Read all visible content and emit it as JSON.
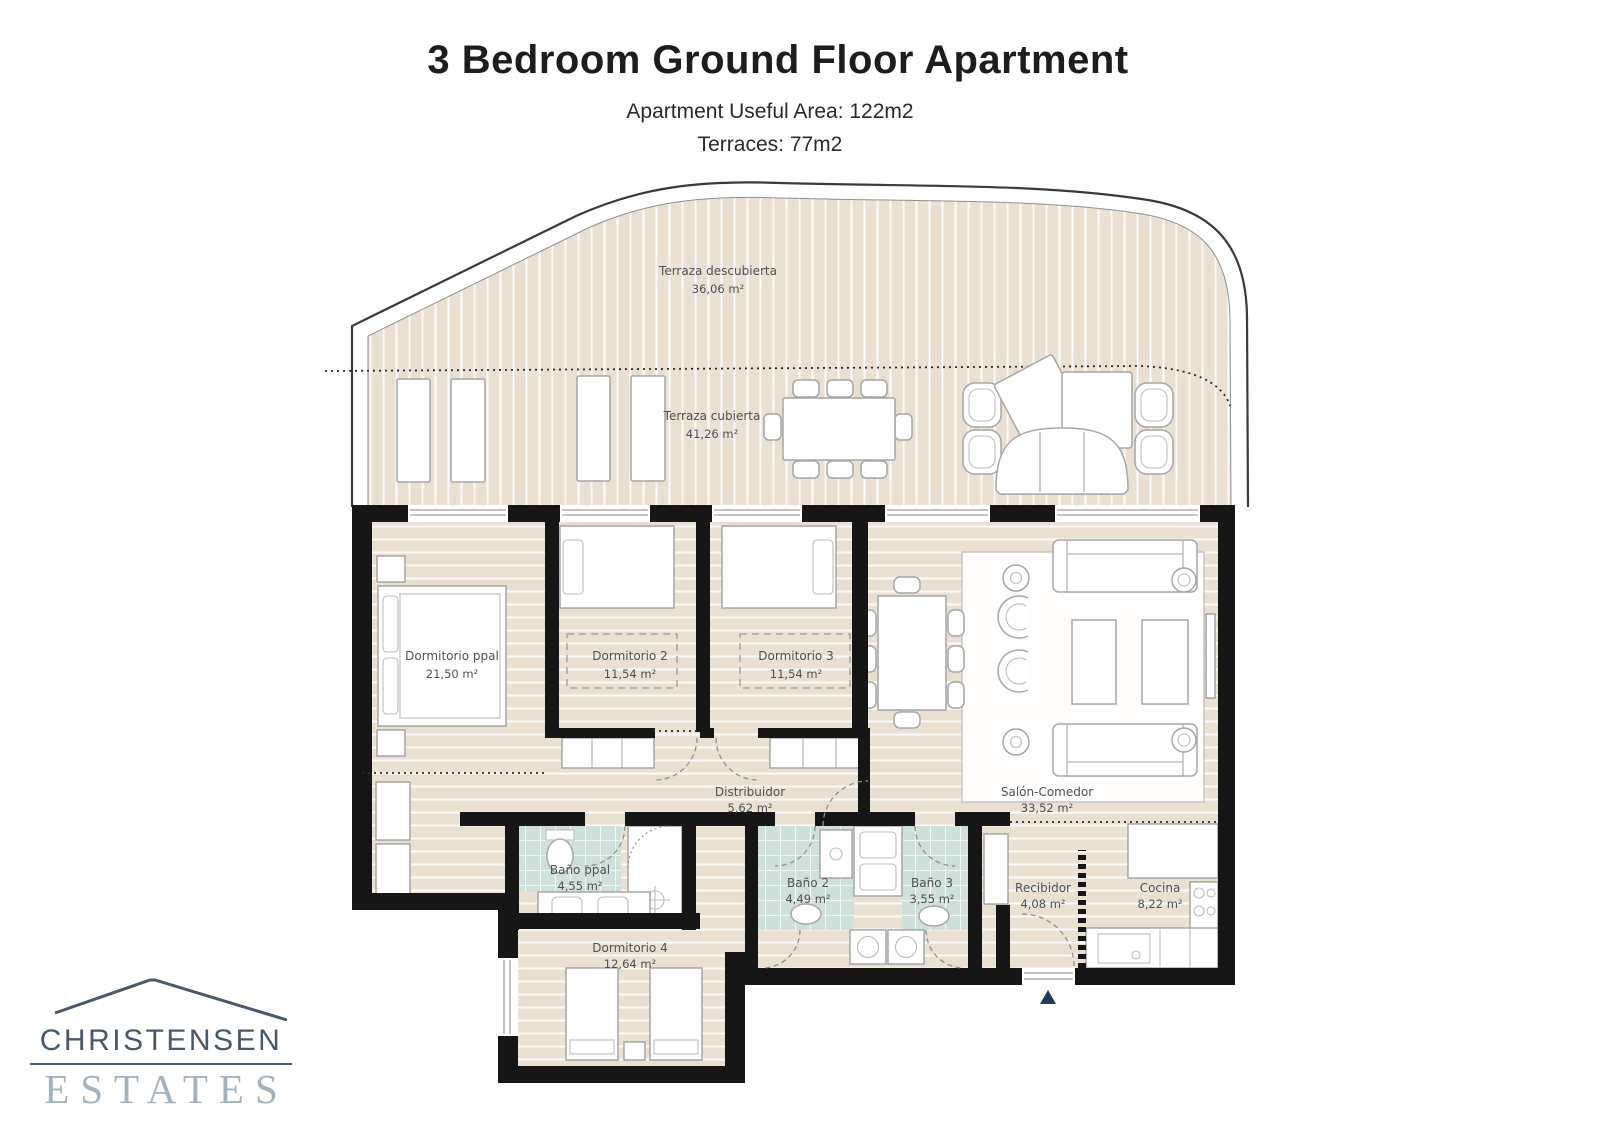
{
  "header": {
    "title": "3 Bedroom Ground Floor Apartment",
    "area_line": "Apartment Useful Area:  122m2",
    "terraces_line": "Terraces: 77m2"
  },
  "rooms": [
    {
      "name": "Terraza descubierta",
      "area": "36,06 m²"
    },
    {
      "name": "Terraza cubierta",
      "area": "41,26 m²"
    },
    {
      "name": "Dormitorio ppal",
      "area": "21,50 m²"
    },
    {
      "name": "Dormitorio 2",
      "area": "11,54 m²"
    },
    {
      "name": "Dormitorio 3",
      "area": "11,54 m²"
    },
    {
      "name": "Distribuidor",
      "area": "5,62 m²"
    },
    {
      "name": "Salón-Comedor",
      "area": "33,52 m²"
    },
    {
      "name": "Baño ppal",
      "area": "4,55 m²"
    },
    {
      "name": "Baño 2",
      "area": "4,49 m²"
    },
    {
      "name": "Baño 3",
      "area": "3,55 m²"
    },
    {
      "name": "Recibidor",
      "area": "4,08 m²"
    },
    {
      "name": "Cocina",
      "area": "8,22 m²"
    },
    {
      "name": "Dormitorio 4",
      "area": "12,64 m²"
    }
  ],
  "logo": {
    "name": "CHRISTENSEN",
    "type": "ESTATES"
  },
  "colors": {
    "wall": "#161616",
    "floor": "#e9e0d2",
    "bath_tile": "#cfdfd9",
    "logo_primary": "#47596a",
    "logo_secondary": "#a4b2bd",
    "entrance_arrow": "#1b3a5c"
  }
}
